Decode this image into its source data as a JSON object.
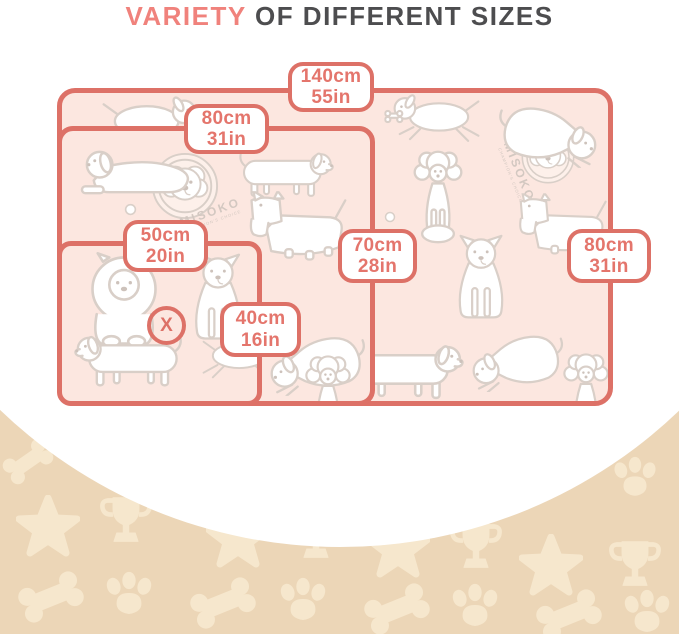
{
  "title": {
    "highlight": "VARIETY",
    "rest": " OF DIFFERENT SIZES"
  },
  "pads": [
    {
      "name": "large pad",
      "length": {
        "cm": "140cm",
        "in": "55in"
      },
      "width": {
        "cm": "80cm",
        "in": "31in"
      }
    },
    {
      "name": "medium pad",
      "length": {
        "cm": "80cm",
        "in": "31in"
      },
      "width": {
        "cm": "70cm",
        "in": "28in"
      }
    },
    {
      "name": "small pad",
      "length": {
        "cm": "50cm",
        "in": "20in"
      },
      "width": {
        "cm": "40cm",
        "in": "16in"
      }
    }
  ],
  "marker": {
    "symbol": "X"
  },
  "brand": {
    "name": "MISOKO",
    "tagline": "CHAMPION'S CHOICE"
  },
  "colors": {
    "accent_coral": "#dd7167",
    "label_text": "#e4756c",
    "title_highlight": "#f0827c",
    "title_text": "#4d4d4f",
    "pad_pink": "#fce7e0",
    "illustration_gray": "#d9cfc8",
    "band_beige": "#ecd6b7",
    "band_icon_beige": "#f6e7cd",
    "white": "#ffffff"
  },
  "decor": {
    "band_icons": [
      "bone-icon",
      "paw-icon",
      "star-icon",
      "trophy-icon"
    ],
    "pad_illustrations": "outlined cartoon dogs pattern"
  }
}
